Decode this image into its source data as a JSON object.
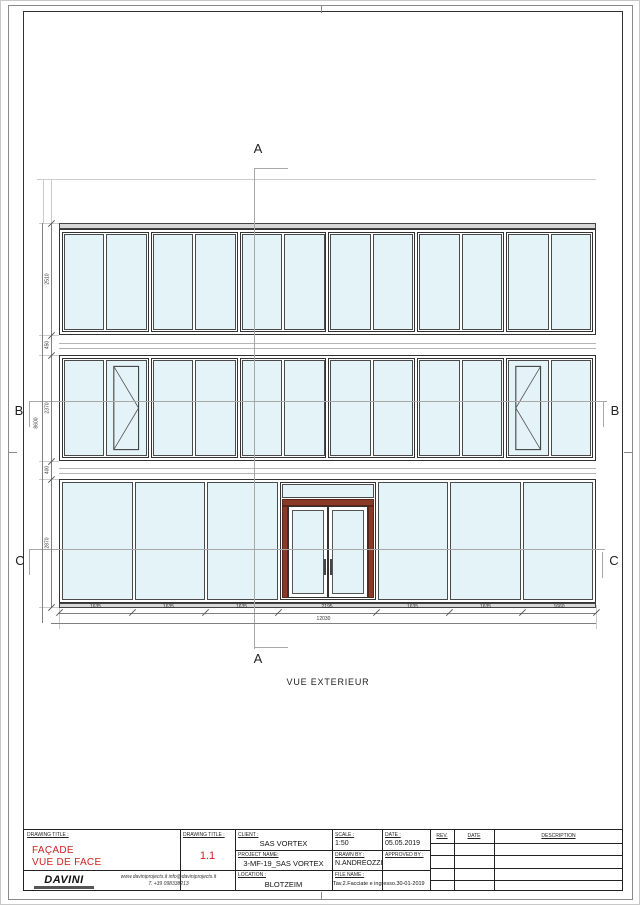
{
  "sheet": {
    "colors": {
      "glass": "#e3f3f8",
      "frame": "#2b2b2b",
      "door_frame": "#8a3b28",
      "accent_red": "#cc2222",
      "line_gray": "#9a9a9a"
    }
  },
  "drawing": {
    "caption": "VUE EXTERIEUR",
    "markers": {
      "a": "A",
      "b": "B",
      "c": "C"
    },
    "facade": {
      "top_band_modules": 6,
      "mid_band_modules": 6,
      "mid_openable_panels": [
        1,
        10
      ],
      "bottom_left_panels": 3,
      "bottom_right_panels": 3
    },
    "dimensions": {
      "bottom_segments": [
        "1635",
        "1635",
        "1635",
        "2195",
        "1635",
        "1635",
        "1660"
      ],
      "bottom_total": "12030",
      "left_segments": [
        "2510",
        "450",
        "2370",
        "400",
        "2870"
      ],
      "left_total": "8600"
    }
  },
  "title_block": {
    "drawing_title_label": "DRAWING TITLE :",
    "title_line1": "FAÇADE",
    "title_line2": "VUE DE FACE",
    "sheet_number_label": "DRAWING TITLE :",
    "sheet_number": "1.1",
    "client_label": "CLIENT :",
    "client": "SAS VORTEX",
    "project_label": "PROJECT NAME:",
    "project": "3-MF-19_SAS VORTEX",
    "location_label": "LOCATION :",
    "location": "BLOTZEIM",
    "scale_label": "SCALE :",
    "scale": "1:50",
    "date_label": "DATE :",
    "date": "05.05.2019",
    "drawn_by_label": "DRAWN BY :",
    "drawn_by": "N.ANDREOZZI",
    "approved_by_label": "APPROVED BY :",
    "approved_by": "",
    "file_name_label": "FILE NAME :",
    "file_name": "Tav.2.Facciate e ingresso.30-01-2019",
    "rev_header": "REV.",
    "rev_date_header": "DATE",
    "rev_description_header": "DESCRIPTION",
    "rev_rows": 4,
    "logo_text": "DAVINI",
    "contact_line1": "www.daviniprojects.it   info@daviniprojects.it",
    "contact_line2": "T. +39 098338213"
  }
}
